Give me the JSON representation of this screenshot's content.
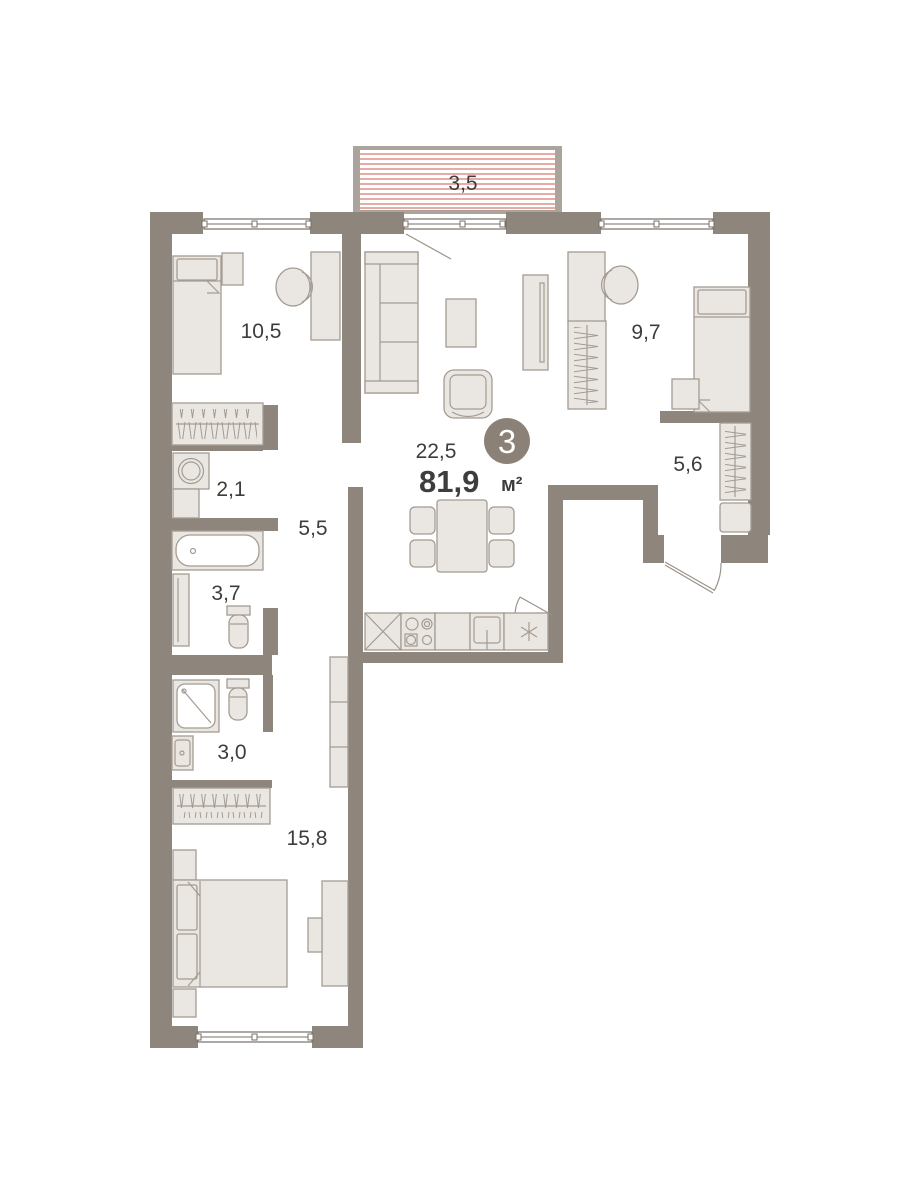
{
  "plan": {
    "unit": {
      "number": "3",
      "total_area": "81,9",
      "area_unit": "м²"
    },
    "balcony": {
      "area": "3,5"
    },
    "rooms": [
      {
        "id": "bedroom-top-left",
        "area": "10,5"
      },
      {
        "id": "living-kitchen",
        "area": "22,5"
      },
      {
        "id": "bedroom-top-right",
        "area": "9,7"
      },
      {
        "id": "entry-hall",
        "area": "5,6"
      },
      {
        "id": "laundry",
        "area": "2,1"
      },
      {
        "id": "hallway",
        "area": "5,5"
      },
      {
        "id": "bathroom",
        "area": "3,7"
      },
      {
        "id": "shower-room",
        "area": "3,0"
      },
      {
        "id": "bedroom-bottom",
        "area": "15,8"
      }
    ],
    "colors": {
      "wall": "#8e857c",
      "balcony_frame": "#aba49c",
      "stripe": "#dd9187",
      "furniture_fill": "#eae7e3",
      "furniture_stroke": "#a49b92",
      "line": "#9a9289",
      "window_line": "#77706a",
      "text": "#3e3d3c",
      "badge_bg": "#8b8177",
      "badge_text": "#ffffff",
      "bg": "#ffffff"
    }
  }
}
